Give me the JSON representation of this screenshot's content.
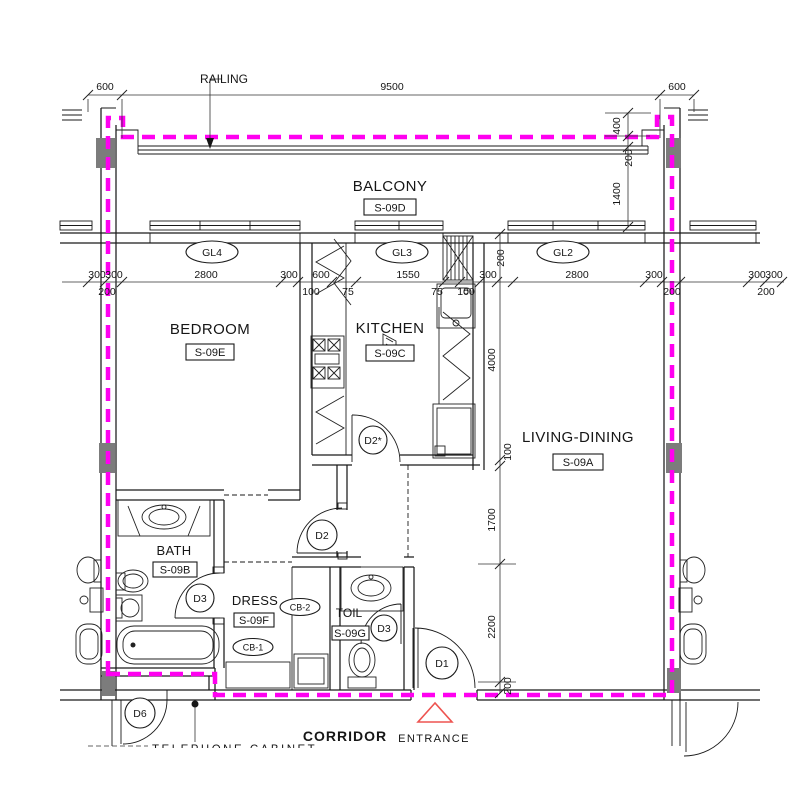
{
  "rooms": {
    "balcony": {
      "name": "BALCONY",
      "tag": "S-09D"
    },
    "bedroom": {
      "name": "BEDROOM",
      "tag": "S-09E"
    },
    "kitchen": {
      "name": "KITCHEN",
      "tag": "S-09C"
    },
    "living_dining": {
      "name": "LIVING-DINING",
      "tag": "S-09A"
    },
    "bath": {
      "name": "BATH",
      "tag": "S-09B"
    },
    "dress": {
      "name": "DRESS",
      "tag": "S-09F"
    },
    "toilet": {
      "name": "TOIL",
      "tag": "S-09G"
    },
    "corridor": {
      "name": "CORRIDOR"
    }
  },
  "annotations": {
    "railing": "RAILING",
    "entrance": "ENTRANCE",
    "clipped_note": "TELEPHONE CABINET"
  },
  "doors": {
    "d1": "D1",
    "d2_hall": "D2",
    "d2_kitchen": "D2*",
    "d3_bath": "D3",
    "d3_toilet": "D3",
    "d6": "D6"
  },
  "windows": {
    "gl4": {
      "label": "GL4",
      "width": "2800"
    },
    "gl3": {
      "label": "GL3",
      "width": "1550"
    },
    "gl2": {
      "label": "GL2",
      "width": "2800"
    }
  },
  "cabinets": {
    "cb1": "CB-1",
    "cb2": "CB-2"
  },
  "dimensions": {
    "top": {
      "left": "600",
      "middle": "9500",
      "right": "600"
    },
    "balcony_side": {
      "a": "400",
      "b": "200",
      "c": "1400"
    },
    "left_edge": {
      "a": "300",
      "b": "300",
      "c": "200"
    },
    "right_edge": {
      "a": "300",
      "b": "300",
      "c": "200"
    },
    "window_row": {
      "a": "300",
      "b": "600",
      "c": "100",
      "d": "75",
      "e": "75",
      "f": "100",
      "g": "300",
      "h": "300",
      "i": "200",
      "pier": "200"
    },
    "vertical_chain": {
      "a": "4000",
      "b": "100",
      "c": "1700",
      "d": "2200",
      "e": "200"
    }
  },
  "colors": {
    "boundary": "#ff00f0",
    "entrance": "#ee5350",
    "column": "#7c7c7c",
    "line": "#1b1b1b"
  }
}
